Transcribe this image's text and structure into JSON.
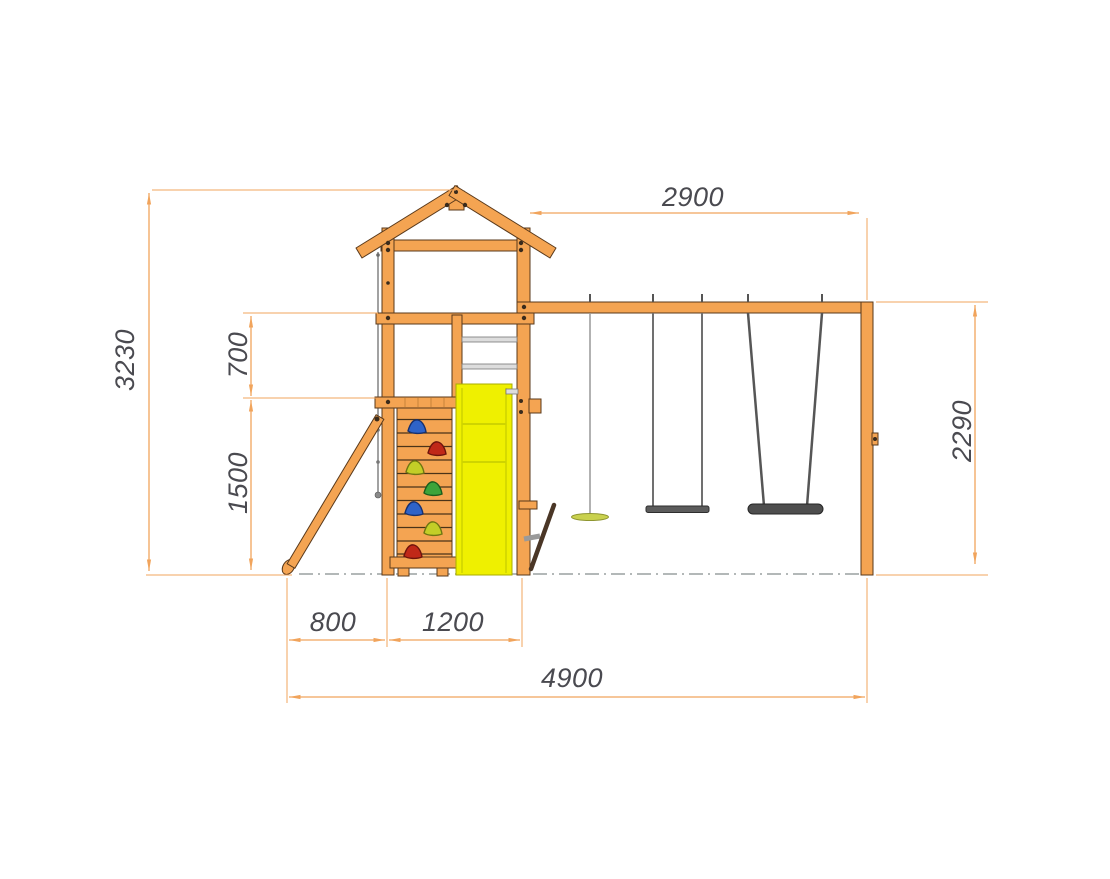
{
  "drawing": {
    "type": "side-elevation dimension drawing of a children's playground set",
    "parts": [
      "gable-roof-tower",
      "climbing-wall",
      "climbing-holds",
      "slide",
      "ladder",
      "hanging-rope",
      "diagonal-brace",
      "swing-beam",
      "disc-swing",
      "flat-seat-swing",
      "nest-swing",
      "end-support-post",
      "ground-line"
    ],
    "dimensions": {
      "overall_height": "3230",
      "rail_to_platform_gap": "700",
      "platform_height": "1500",
      "swing_bay_length": "2900",
      "swing_frame_height": "2290",
      "brace_footprint": "800",
      "tower_footprint": "1200",
      "overall_length": "4900"
    },
    "colors": {
      "wood": "#F4A452",
      "wood_outline": "#59391B",
      "slide_yellow": "#EFF000",
      "dimension_line": "#F1A45C",
      "dimension_text": "#4A4A50",
      "rope_gray": "#8A8A8A",
      "seat_dark": "#4E4E4E",
      "disc_green": "#C9D14E",
      "hold_blue": "#2E63C8",
      "hold_red": "#C02818",
      "hold_yellow": "#C3CE27",
      "hold_green": "#3DA43A"
    }
  }
}
